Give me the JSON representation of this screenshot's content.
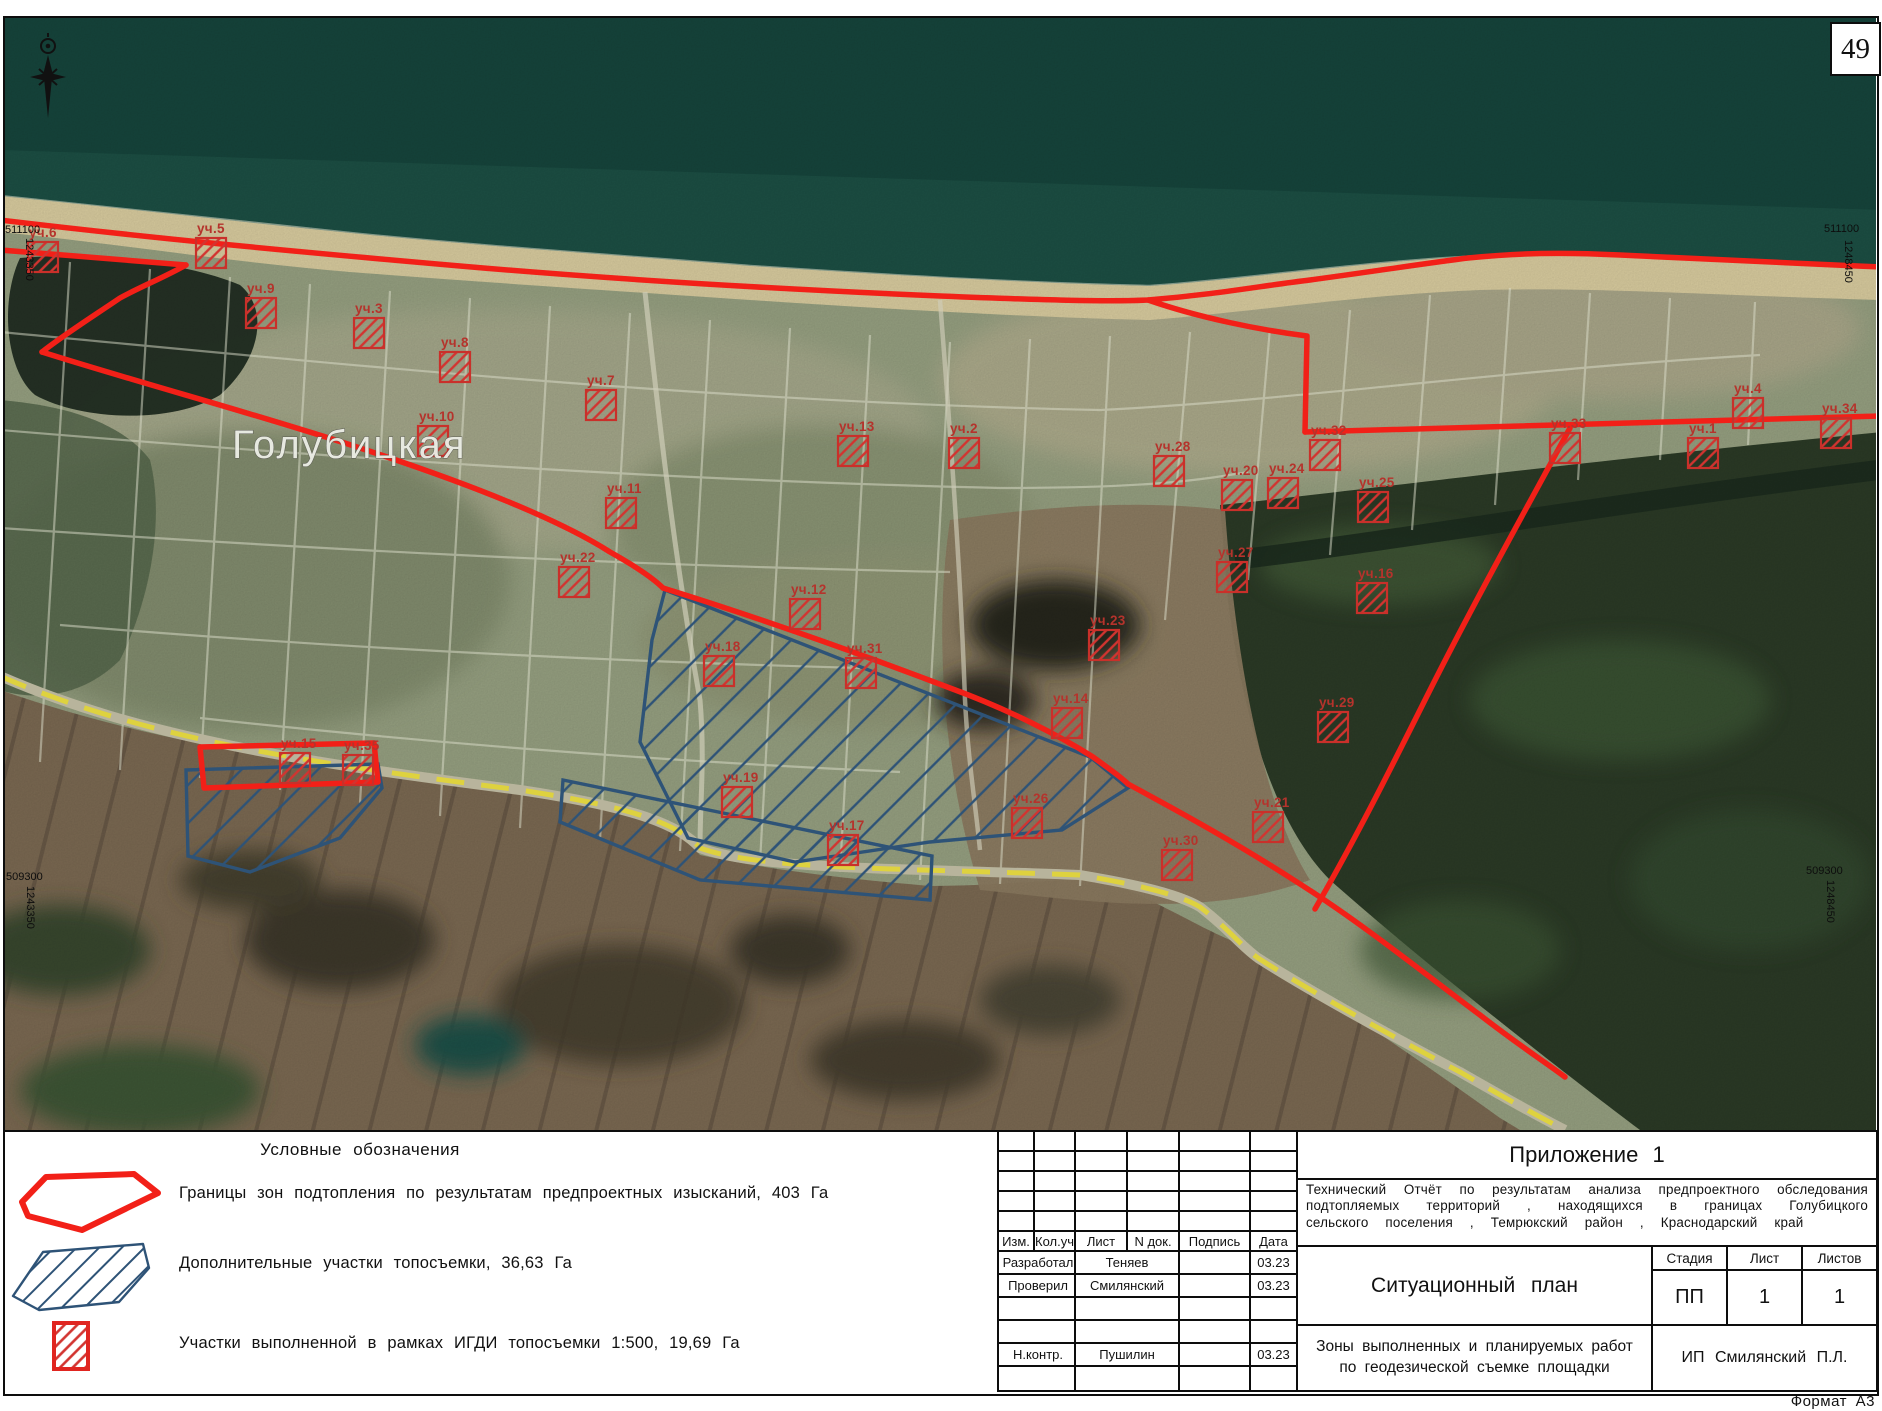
{
  "page": {
    "number": "49",
    "format_label": "Формат А3"
  },
  "map": {
    "town_label": "Голубицкая",
    "coordinates": {
      "top_left": {
        "x_label": "511100",
        "y_label": "1243350"
      },
      "top_right": {
        "x_label": "511100",
        "y_label": "1248450"
      },
      "bottom_left": {
        "x_label": "509300",
        "y_label": "1243350"
      },
      "bottom_right": {
        "x_label": "509300",
        "y_label": "1248450"
      }
    },
    "colors": {
      "flood_boundary_red": "#f22018",
      "marker_red": "#c9302a",
      "topo_blue": "#2e5377",
      "road_yellow": "#ded23f",
      "sea": "#16453c",
      "beach": "#d9cc9f",
      "fields_brown": "#7b6952"
    },
    "markers": [
      {
        "label": "уч.6",
        "x": 28,
        "y": 242
      },
      {
        "label": "уч.5",
        "x": 196,
        "y": 238
      },
      {
        "label": "уч.9",
        "x": 246,
        "y": 298
      },
      {
        "label": "уч.3",
        "x": 354,
        "y": 318
      },
      {
        "label": "уч.8",
        "x": 440,
        "y": 352
      },
      {
        "label": "уч.7",
        "x": 586,
        "y": 390
      },
      {
        "label": "уч.10",
        "x": 418,
        "y": 426
      },
      {
        "label": "уч.11",
        "x": 606,
        "y": 498
      },
      {
        "label": "уч.22",
        "x": 559,
        "y": 567
      },
      {
        "label": "уч.13",
        "x": 838,
        "y": 436
      },
      {
        "label": "уч.2",
        "x": 949,
        "y": 438
      },
      {
        "label": "уч.28",
        "x": 1154,
        "y": 456
      },
      {
        "label": "уч.12",
        "x": 790,
        "y": 599
      },
      {
        "label": "уч.23",
        "x": 1089,
        "y": 630
      },
      {
        "label": "уч.27",
        "x": 1217,
        "y": 562
      },
      {
        "label": "уч.20",
        "x": 1222,
        "y": 480
      },
      {
        "label": "уч.16",
        "x": 1357,
        "y": 583
      },
      {
        "label": "уч.25",
        "x": 1358,
        "y": 492
      },
      {
        "label": "уч.32",
        "x": 1310,
        "y": 440
      },
      {
        "label": "уч.33",
        "x": 1550,
        "y": 433
      },
      {
        "label": "уч.1",
        "x": 1688,
        "y": 438
      },
      {
        "label": "уч.4",
        "x": 1733,
        "y": 398
      },
      {
        "label": "уч.34",
        "x": 1821,
        "y": 418
      },
      {
        "label": "уч.24",
        "x": 1268,
        "y": 478
      },
      {
        "label": "уч.31",
        "x": 846,
        "y": 658
      },
      {
        "label": "уч.18",
        "x": 704,
        "y": 656
      },
      {
        "label": "уч.14",
        "x": 1052,
        "y": 708
      },
      {
        "label": "уч.29",
        "x": 1318,
        "y": 712
      },
      {
        "label": "уч.21",
        "x": 1253,
        "y": 812
      },
      {
        "label": "уч.30",
        "x": 1162,
        "y": 850
      },
      {
        "label": "уч.26",
        "x": 1012,
        "y": 808
      },
      {
        "label": "уч.19",
        "x": 722,
        "y": 787
      },
      {
        "label": "уч.17",
        "x": 828,
        "y": 835
      },
      {
        "label": "уч.15",
        "x": 280,
        "y": 753
      },
      {
        "label": "уч.35",
        "x": 343,
        "y": 755
      }
    ]
  },
  "legend": {
    "title": "Условные обозначения",
    "items": [
      {
        "symbol": "flood-zone-outline",
        "text": "Границы зон подтопления по результатам предпроектных изысканий, 403 Га"
      },
      {
        "symbol": "additional-topo-hatch",
        "text": "Дополнительные участки топосъемки, 36,63 Га"
      },
      {
        "symbol": "igdi-topo-hatch",
        "text": "Участки выполненной в рамках ИГДИ топосъемки 1:500, 19,69 Га"
      }
    ]
  },
  "title_block": {
    "appendix": "Приложение 1",
    "project": "Технический Отчёт по результатам анализа предпроектного обследования подтопляемых территорий , находящихся в границах Голубицкого сельского поселения , Темрюкский район , Краснодарский край",
    "drawing_title": "Ситуационный план",
    "sheet_title": "Зоны выполненных и планируемых работ по геодезической съемке площадки",
    "company": "ИП Смилянский П.Л.",
    "stage_header": "Стадия",
    "sheet_header": "Лист",
    "sheets_header": "Листов",
    "stage": "ПП",
    "sheet": "1",
    "sheets": "1",
    "sig_headers": [
      "Изм.",
      "Кол.уч",
      "Лист",
      "N док.",
      "Подпись",
      "Дата"
    ],
    "sig_rows": [
      {
        "role": "Разработал",
        "name": "Теняев",
        "sign": "",
        "date": "03.23"
      },
      {
        "role": "Проверил",
        "name": "Смилянский",
        "sign": "",
        "date": "03.23"
      },
      {
        "role": "",
        "name": "",
        "sign": "",
        "date": ""
      },
      {
        "role": "",
        "name": "",
        "sign": "",
        "date": ""
      },
      {
        "role": "Н.контр.",
        "name": "Пушилин",
        "sign": "",
        "date": "03.23"
      }
    ]
  }
}
